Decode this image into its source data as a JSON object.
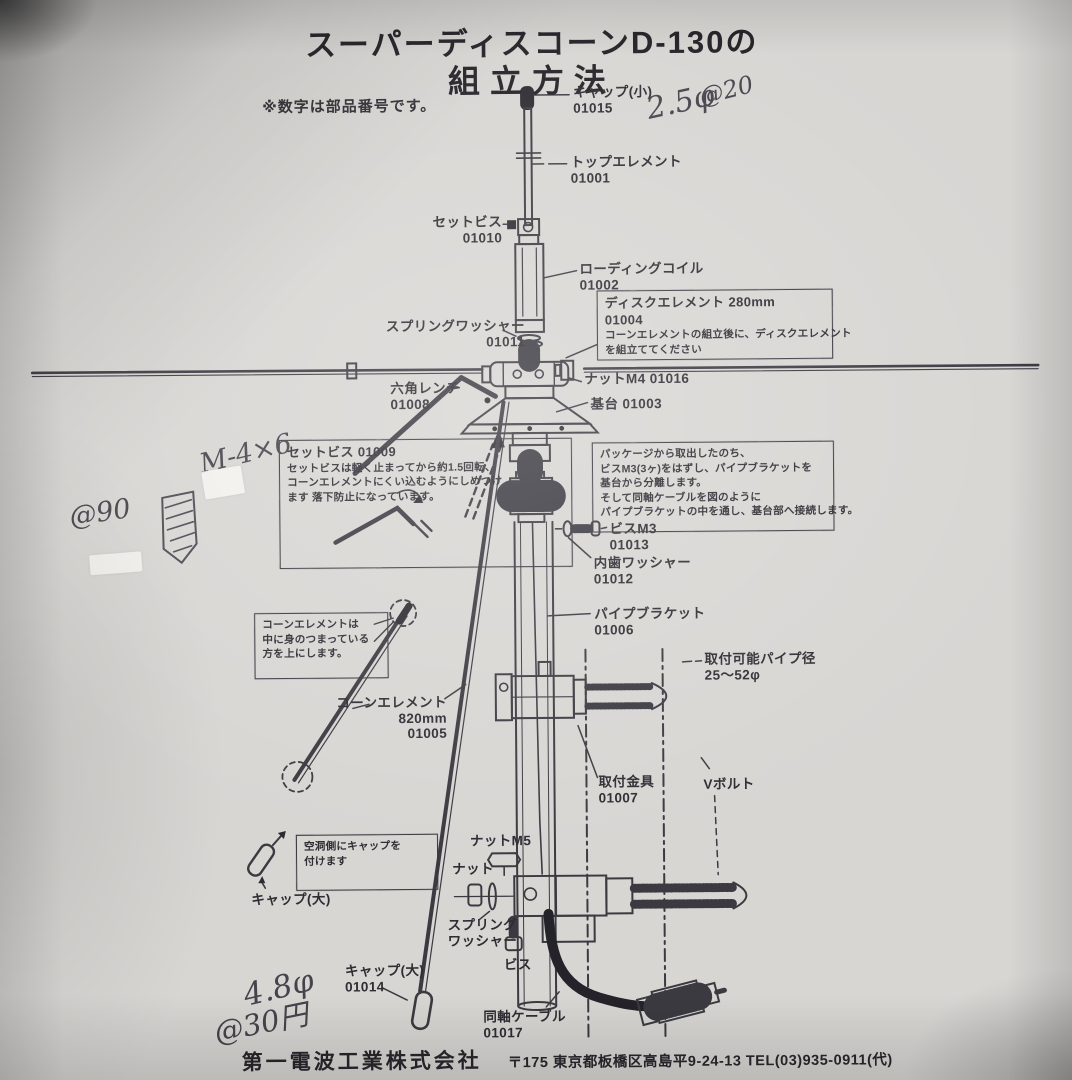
{
  "document": {
    "title_line1": "スーパーディスコーンD-130の",
    "title_line2": "組立方法",
    "note": "※数字は部品番号です。",
    "footer": {
      "company": "第一電波工業株式会社",
      "address": "〒175 東京都板橋区高島平9-24-13 TEL(03)935-0911(代)"
    }
  },
  "part_labels": [
    {
      "id": "cap-small",
      "lines": [
        "キャップ(小)",
        "01015"
      ],
      "x": 577,
      "y": 85,
      "align": "left"
    },
    {
      "id": "top-element",
      "lines": [
        "トップエレメント",
        "01001"
      ],
      "x": 574,
      "y": 155,
      "align": "left"
    },
    {
      "id": "set-screw-01010",
      "lines": [
        "セットビス",
        "01010"
      ],
      "x": 505,
      "y": 214,
      "align": "right"
    },
    {
      "id": "loading-coil",
      "lines": [
        "ローディングコイル",
        "01002"
      ],
      "x": 582,
      "y": 262,
      "align": "left"
    },
    {
      "id": "spring-washer-01011",
      "lines": [
        "スプリングワッシャー",
        "01011"
      ],
      "x": 527,
      "y": 318,
      "align": "right"
    },
    {
      "id": "nut-m4",
      "lines": [
        "ナットM4 01016"
      ],
      "x": 586,
      "y": 372,
      "align": "left"
    },
    {
      "id": "hex-wrench",
      "lines": [
        "六角レンチ",
        "01008"
      ],
      "x": 392,
      "y": 380,
      "align": "left"
    },
    {
      "id": "base",
      "lines": [
        "基台 01003"
      ],
      "x": 592,
      "y": 397,
      "align": "left"
    },
    {
      "id": "screw-m3",
      "lines": [
        "ビスM3",
        "01013"
      ],
      "x": 610,
      "y": 522,
      "align": "left"
    },
    {
      "id": "inner-tooth-washer",
      "lines": [
        "内歯ワッシャー",
        "01012"
      ],
      "x": 594,
      "y": 556,
      "align": "left"
    },
    {
      "id": "pipe-bracket",
      "lines": [
        "パイプブラケット",
        "01006"
      ],
      "x": 594,
      "y": 607,
      "align": "left"
    },
    {
      "id": "cone-element",
      "lines": [
        "コーンエレメント",
        "820mm",
        "01005"
      ],
      "x": 446,
      "y": 694,
      "align": "right"
    },
    {
      "id": "mountable-pipe-dia",
      "lines": [
        "取付可能パイプ径",
        "25〜52φ"
      ],
      "x": 704,
      "y": 653,
      "align": "left"
    },
    {
      "id": "mount-bracket",
      "lines": [
        "取付金具",
        "01007"
      ],
      "x": 597,
      "y": 775,
      "align": "left"
    },
    {
      "id": "v-bolt",
      "lines": [
        "Vボルト"
      ],
      "x": 702,
      "y": 778,
      "align": "left"
    },
    {
      "id": "nut-m5",
      "lines": [
        "ナットM5"
      ],
      "x": 468,
      "y": 833,
      "align": "left"
    },
    {
      "id": "nut",
      "lines": [
        "ナット"
      ],
      "x": 450,
      "y": 861,
      "align": "left"
    },
    {
      "id": "cap-large",
      "lines": [
        "キャップ(大)"
      ],
      "x": 249,
      "y": 890,
      "align": "left"
    },
    {
      "id": "spring-washer-2",
      "lines": [
        "スプリング",
        "ワッシャー"
      ],
      "x": 445,
      "y": 917,
      "align": "left"
    },
    {
      "id": "screw",
      "lines": [
        "ビス"
      ],
      "x": 501,
      "y": 957,
      "align": "left"
    },
    {
      "id": "cap-large-01014",
      "lines": [
        "キャップ(大)",
        "01014"
      ],
      "x": 342,
      "y": 962,
      "align": "left"
    },
    {
      "id": "coax-cable",
      "lines": [
        "同軸ケーブル",
        "01017"
      ],
      "x": 480,
      "y": 1009,
      "align": "left"
    }
  ],
  "note_boxes": [
    {
      "id": "disc-element-box",
      "x": 599,
      "y": 291,
      "w": 220,
      "h": 61,
      "title_lines": [
        "ディスクエレメント 280mm",
        "01004"
      ],
      "body_lines": [
        "コーンエレメントの組立後に、ディスクエレメント",
        "を組立ててください"
      ]
    },
    {
      "id": "set-screw-box",
      "x": 280,
      "y": 438,
      "w": 277,
      "h": 120,
      "title_lines": [
        "セットビス 01009"
      ],
      "body_lines": [
        "セットビスは軽く止まってから約1.5回転、",
        "コーンエレメントにくい込むようにしめつけ",
        "ます 落下防止になっています。"
      ]
    },
    {
      "id": "pipe-bracket-box",
      "x": 593,
      "y": 443,
      "w": 226,
      "h": 81,
      "title_lines": [],
      "body_lines": [
        "パッケージから取出したのち、",
        "ビスM3(3ヶ)をはずし、パイプブラケットを",
        "基台から分離します。",
        "そして同軸ケーブルを図のように",
        "パイプブラケットの中を通し、基台部へ接続します。"
      ]
    },
    {
      "id": "cone-element-note",
      "x": 254,
      "y": 611,
      "w": 118,
      "h": 57,
      "title_lines": [],
      "body_lines": [
        "コーンエレメントは",
        "中に身のつまっている",
        "方を上にします。"
      ]
    },
    {
      "id": "cap-note",
      "x": 294,
      "y": 833,
      "w": 126,
      "h": 47,
      "title_lines": [],
      "body_lines": [
        "空洞側にキャップを",
        "付けます"
      ]
    }
  ],
  "handwritten_notes": [
    {
      "id": "hw-2-5-phi",
      "text": "2.5φ",
      "x": 650,
      "y": 86,
      "size": 30,
      "rot": -12
    },
    {
      "id": "hw-at-20",
      "text": "@20",
      "x": 703,
      "y": 78,
      "size": 24,
      "rot": -14
    },
    {
      "id": "hw-m-4x6",
      "text": "M-4×6",
      "x": 200,
      "y": 436,
      "size": 27,
      "rot": -13
    },
    {
      "id": "hw-at-90",
      "text": "@90",
      "x": 70,
      "y": 494,
      "size": 27,
      "rot": -8
    },
    {
      "id": "hw-4-8-phi",
      "text": "4.8φ",
      "x": 240,
      "y": 968,
      "size": 31,
      "rot": -13
    },
    {
      "id": "hw-at-30-yen",
      "text": "@30円",
      "x": 210,
      "y": 998,
      "size": 29,
      "rot": -11
    }
  ]
}
